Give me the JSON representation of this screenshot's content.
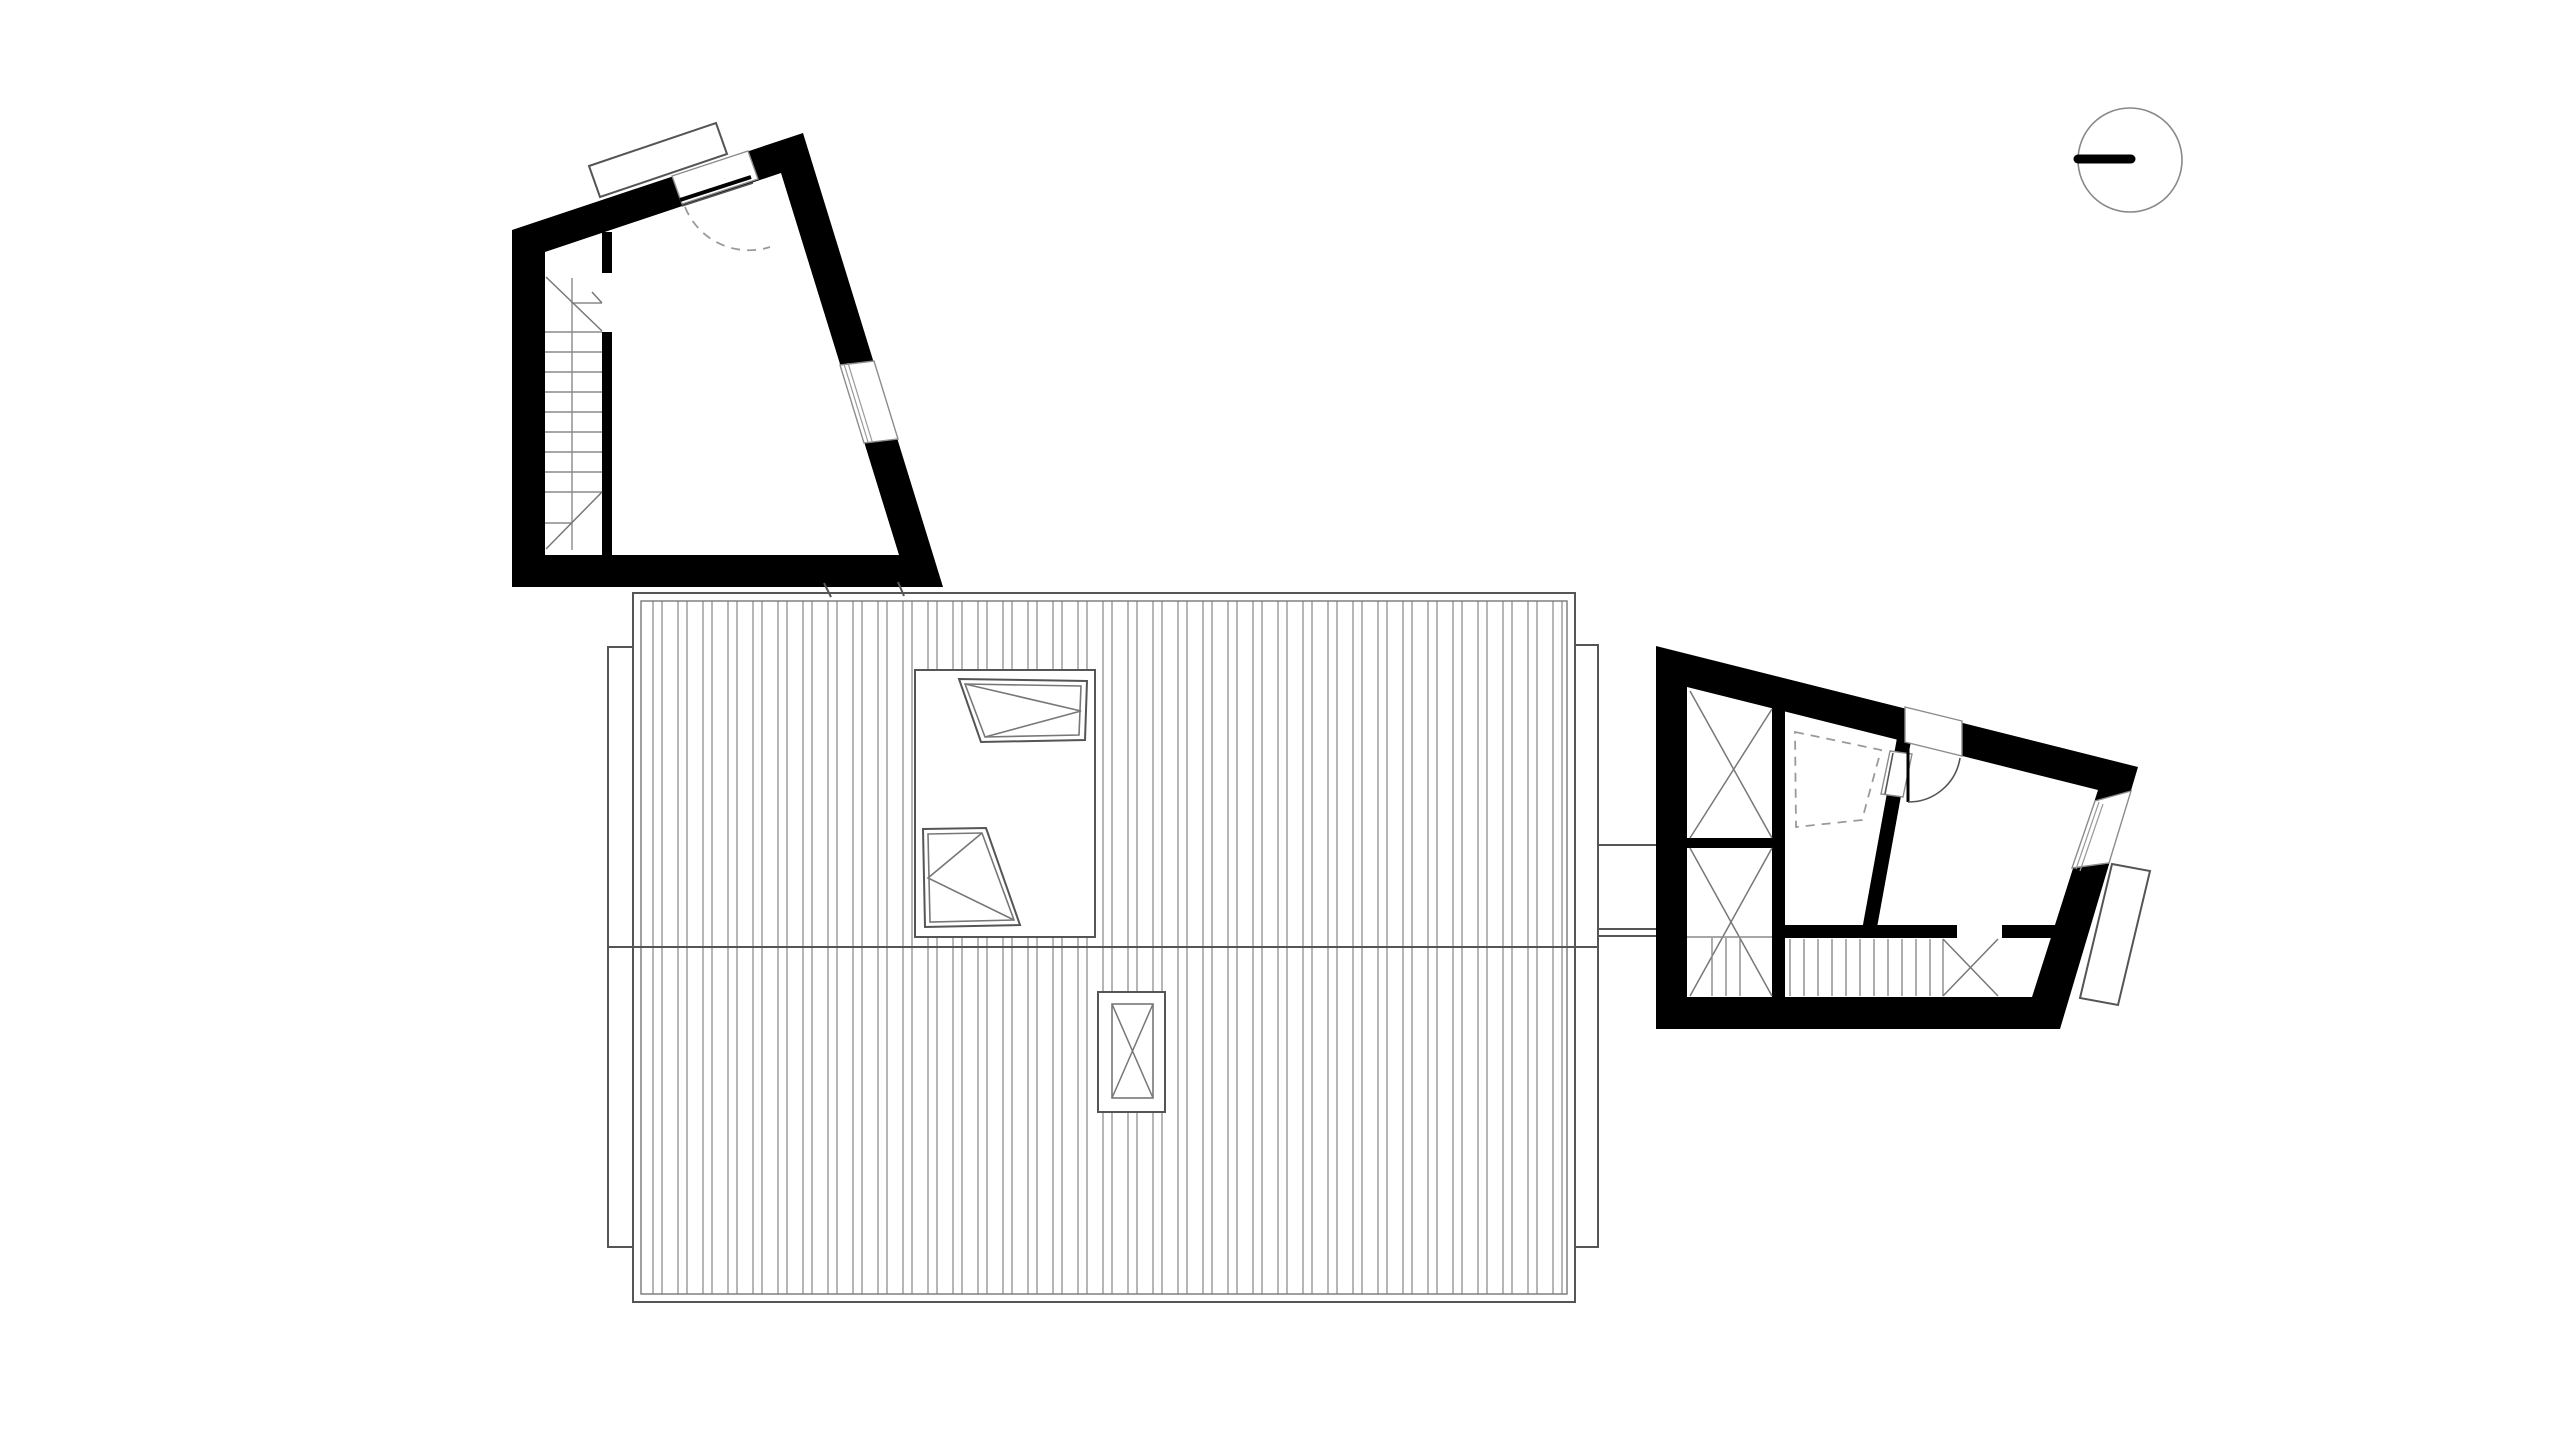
{
  "meta": {
    "kind": "architectural floor plan drawing",
    "view": "upper level / roof plan, black poché walls on white",
    "text_on_sheet": "none"
  },
  "colors": {
    "background": "#ffffff",
    "wall": "#000000",
    "outline": "#555555",
    "detail": "#777777",
    "hatch": "#8f8f8f",
    "dashed": "#9a9a9a",
    "north_circle": "#888888"
  },
  "north_indicator": {
    "type": "circle with solid half-bar pointer",
    "position": "top right"
  },
  "left_annex": {
    "label": "left annex volume",
    "features": [
      "straight stair, 9 treads with break diagonals",
      "entry door with closed slab and dashed quarter-circle swing",
      "canopy outline above entry",
      "window in slanted east wall"
    ]
  },
  "main_roof": {
    "label": "main house roof",
    "features": [
      "vertical standing-seam hatching",
      "horizontal ridge line",
      "roof-window curb with 2 openable skylights",
      "small roof hatch with X",
      "left eave strip",
      "right eave strip",
      "two wall ticks at top edge"
    ],
    "skylight_opening_marks": [
      "V pointing right",
      "V pointing left"
    ]
  },
  "connector": {
    "label": "link between roof eave and right annex",
    "lines": 3
  },
  "right_annex": {
    "label": "right annex volume",
    "features": [
      "two wardrobes with X symbols",
      "bathroom with dashed shower tray",
      "interior slanted bathroom wall with door",
      "entry door with quarter-circle swing",
      "straight stair, 13 treads with X break",
      "window in slanted east wall",
      "balcony outline"
    ]
  },
  "counts": {
    "left_annex_stair_treads": 9,
    "right_annex_stair_treads": 13,
    "roof_skylights": 2,
    "roof_hatches": 1,
    "wardrobes": 2
  }
}
